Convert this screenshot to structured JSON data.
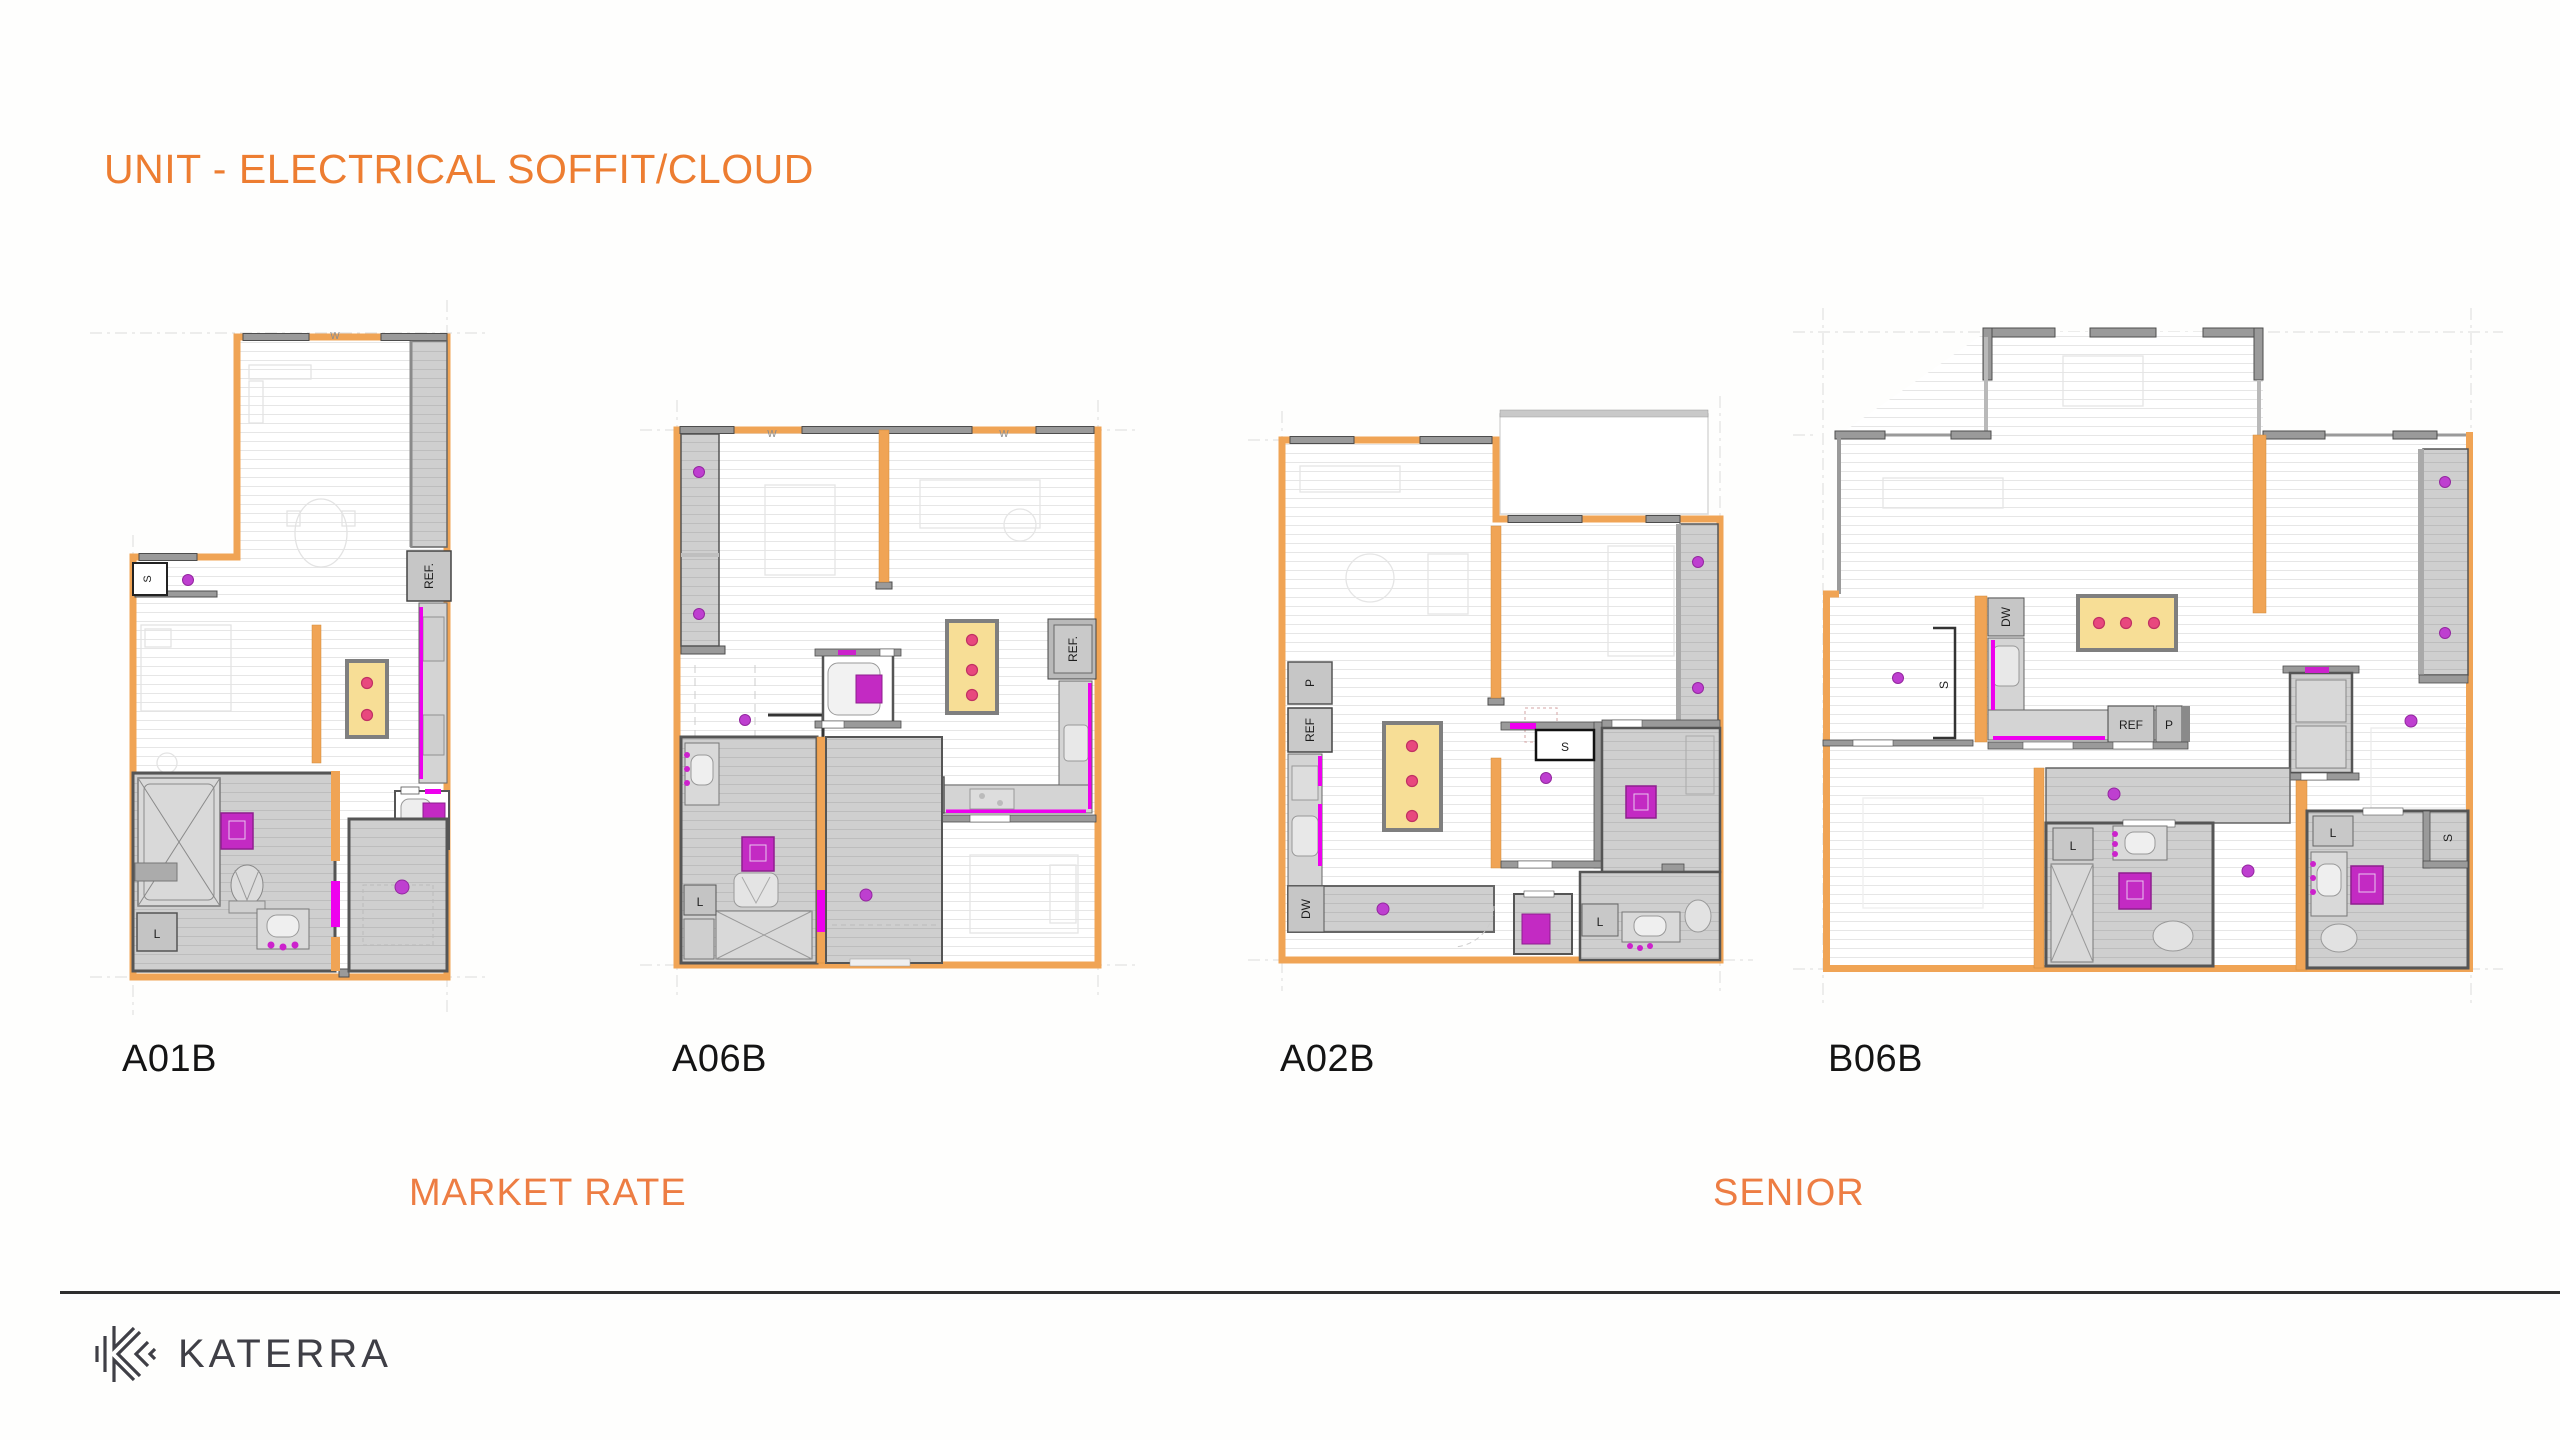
{
  "slide": {
    "title": "UNIT - ELECTRICAL SOFFIT/CLOUD",
    "footer_brand": "KATERRA"
  },
  "sections": {
    "market_rate": "MARKET RATE",
    "senior": "SENIOR"
  },
  "plans": [
    {
      "name": "A01B",
      "category": "MARKET RATE",
      "soffit_lights": 2,
      "labels": {
        "w": "W",
        "s": "S",
        "ref": "REF.",
        "l": "L"
      }
    },
    {
      "name": "A06B",
      "category": "MARKET RATE",
      "soffit_lights": 3,
      "labels": {
        "w": "W",
        "w2": "W",
        "s": "S",
        "ref": "REF.",
        "p": "P",
        "l": "L"
      }
    },
    {
      "name": "A02B",
      "category": "SENIOR",
      "soffit_lights": 3,
      "labels": {
        "p": "P",
        "ref": "REF",
        "dw": "DW",
        "s": "S",
        "l": "L"
      }
    },
    {
      "name": "B06B",
      "category": "SENIOR",
      "soffit_lights": 3,
      "labels": {
        "dw": "DW",
        "ref": "REF",
        "p": "P",
        "s": "S",
        "s2": "S",
        "l": "L",
        "l2": "L"
      }
    }
  ],
  "colors": {
    "accent_orange": "#ED7D31",
    "wall_orange": "#F0A455",
    "wall_gray": "#9A9A9A",
    "wall_dark": "#4D4D4D",
    "room_gray": "#CFCFCF",
    "soffit_yellow": "#F7DE96",
    "soffit_border": "#7F7F7F",
    "soffit_light_pink": "#E8487E",
    "ceiling_light_purple": "#BE3FD0",
    "device_magenta": "#EE00EE",
    "appliance_magenta": "#C32AC3",
    "brand_dark": "#3F3F46"
  }
}
